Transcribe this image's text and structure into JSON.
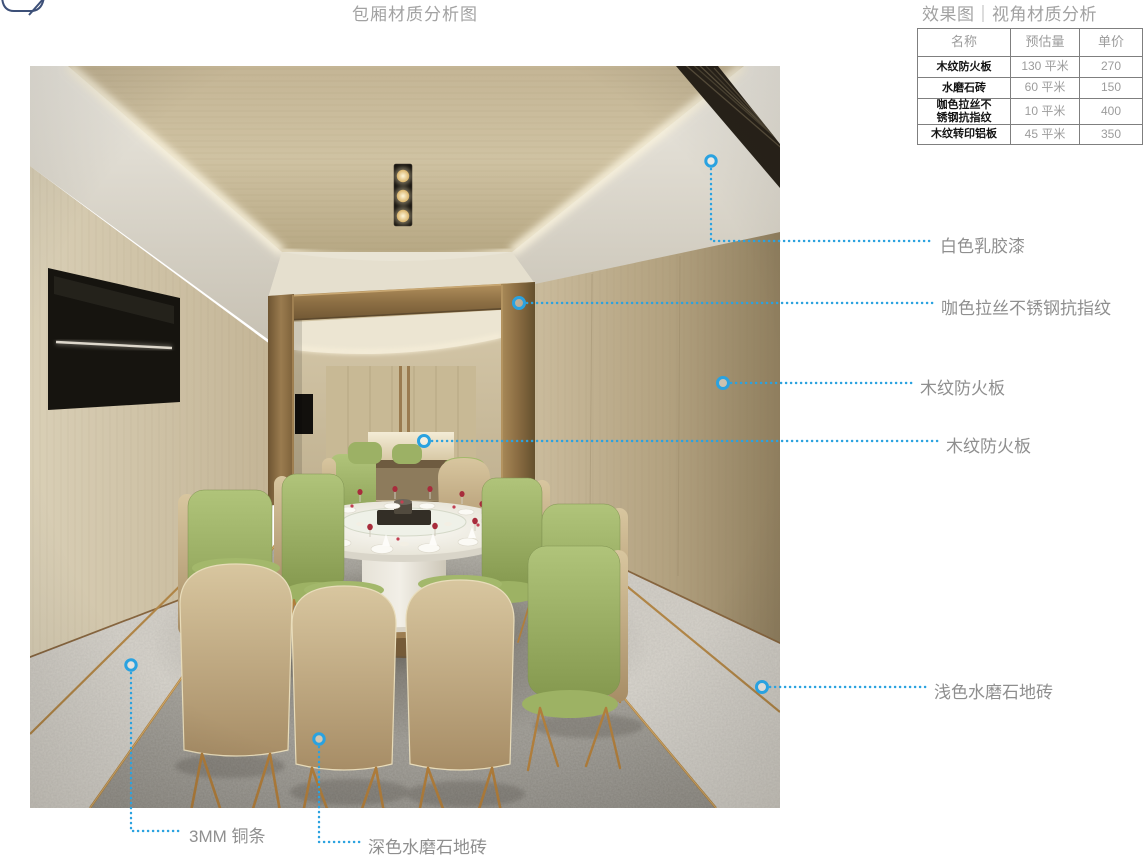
{
  "page": {
    "title": "包厢材质分析图",
    "subtitle": "效果图｜视角材质分析"
  },
  "materials_table": {
    "columns": [
      "名称",
      "预估量",
      "单价"
    ],
    "rows": [
      {
        "name": "木纹防火板",
        "quantity": "130 平米",
        "price": "270"
      },
      {
        "name": "水磨石砖",
        "quantity": "60 平米",
        "price": "150"
      },
      {
        "name": "咖色拉丝不\n锈钢抗指纹",
        "quantity": "10 平米",
        "price": "400"
      },
      {
        "name": "木纹转印铝板",
        "quantity": "45 平米",
        "price": "350"
      }
    ]
  },
  "callouts": [
    {
      "label": "白色乳胶漆"
    },
    {
      "label": "咖色拉丝不锈钢抗指纹"
    },
    {
      "label": "木纹防火板"
    },
    {
      "label": "木纹防火板"
    },
    {
      "label": "浅色水磨石地砖"
    },
    {
      "label": "3MM 铜条"
    },
    {
      "label": "深色水磨石地砖"
    }
  ],
  "colors": {
    "accent_blue": "#2aa2e0",
    "label_gray": "#8f8f8f",
    "title_gray": "#a2a2a2",
    "bronze": "#9a7b4f",
    "chair_green": "#9cb165"
  }
}
